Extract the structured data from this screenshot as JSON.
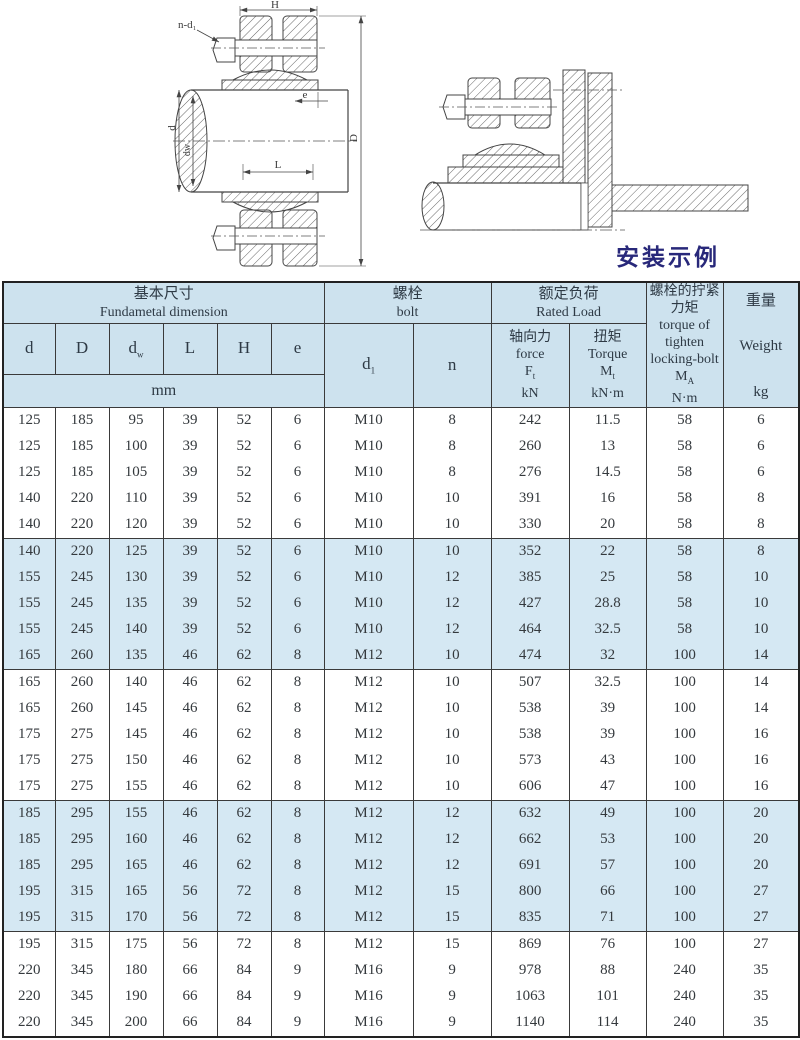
{
  "page": {
    "background": "#ffffff"
  },
  "drawing_left": {
    "labels": {
      "h": "H",
      "nd1": "n-d₁",
      "d": "d",
      "dw": "dw",
      "l": "L",
      "e": "e",
      "big_d": "D"
    }
  },
  "drawing_right": {
    "caption": "安装示例"
  },
  "colors": {
    "header_bg": "#cde2ee",
    "band_bg": "#d5e8f3",
    "caption": "#28287a",
    "border": "#3a3a3a"
  },
  "table": {
    "header": {
      "basic": {
        "zh": "基本尺寸",
        "en": "Fundametal  dimension",
        "unit": "mm"
      },
      "cols": [
        {
          "base": "d",
          "sub": ""
        },
        {
          "base": "D",
          "sub": ""
        },
        {
          "base": "d",
          "sub": "w"
        },
        {
          "base": "L",
          "sub": ""
        },
        {
          "base": "H",
          "sub": ""
        },
        {
          "base": "e",
          "sub": ""
        }
      ],
      "bolt": {
        "zh": "螺栓",
        "en": "bolt",
        "d_base": "d",
        "d_sub": "1",
        "n": "n"
      },
      "load": {
        "zh": "额定负荷",
        "en": "Rated Load"
      },
      "force": {
        "zh": "轴向力",
        "en": "force",
        "sym": "F",
        "sym_sub": "t",
        "unit": "kN"
      },
      "torque": {
        "zh": "扭矩",
        "en": "Torque",
        "sym": "M",
        "sym_sub": "t",
        "unit": "kN·m"
      },
      "tighten": {
        "zh1": "螺栓的拧紧",
        "zh2": "力矩",
        "en1": "torque of",
        "en2": "tighten",
        "en3": "locking-bolt",
        "sym": "M",
        "sym_sub": "A",
        "unit": "N·m"
      },
      "weight": {
        "zh": "重量",
        "en": "Weight",
        "unit": "kg"
      }
    },
    "rows": [
      [
        "125",
        "185",
        "95",
        "39",
        "52",
        "6",
        "M10",
        "8",
        "242",
        "11.5",
        "58",
        "6"
      ],
      [
        "125",
        "185",
        "100",
        "39",
        "52",
        "6",
        "M10",
        "8",
        "260",
        "13",
        "58",
        "6"
      ],
      [
        "125",
        "185",
        "105",
        "39",
        "52",
        "6",
        "M10",
        "8",
        "276",
        "14.5",
        "58",
        "6"
      ],
      [
        "140",
        "220",
        "110",
        "39",
        "52",
        "6",
        "M10",
        "10",
        "391",
        "16",
        "58",
        "8"
      ],
      [
        "140",
        "220",
        "120",
        "39",
        "52",
        "6",
        "M10",
        "10",
        "330",
        "20",
        "58",
        "8"
      ],
      [
        "140",
        "220",
        "125",
        "39",
        "52",
        "6",
        "M10",
        "10",
        "352",
        "22",
        "58",
        "8"
      ],
      [
        "155",
        "245",
        "130",
        "39",
        "52",
        "6",
        "M10",
        "12",
        "385",
        "25",
        "58",
        "10"
      ],
      [
        "155",
        "245",
        "135",
        "39",
        "52",
        "6",
        "M10",
        "12",
        "427",
        "28.8",
        "58",
        "10"
      ],
      [
        "155",
        "245",
        "140",
        "39",
        "52",
        "6",
        "M10",
        "12",
        "464",
        "32.5",
        "58",
        "10"
      ],
      [
        "165",
        "260",
        "135",
        "46",
        "62",
        "8",
        "M12",
        "10",
        "474",
        "32",
        "100",
        "14"
      ],
      [
        "165",
        "260",
        "140",
        "46",
        "62",
        "8",
        "M12",
        "10",
        "507",
        "32.5",
        "100",
        "14"
      ],
      [
        "165",
        "260",
        "145",
        "46",
        "62",
        "8",
        "M12",
        "10",
        "538",
        "39",
        "100",
        "14"
      ],
      [
        "175",
        "275",
        "145",
        "46",
        "62",
        "8",
        "M12",
        "10",
        "538",
        "39",
        "100",
        "16"
      ],
      [
        "175",
        "275",
        "150",
        "46",
        "62",
        "8",
        "M12",
        "10",
        "573",
        "43",
        "100",
        "16"
      ],
      [
        "175",
        "275",
        "155",
        "46",
        "62",
        "8",
        "M12",
        "10",
        "606",
        "47",
        "100",
        "16"
      ],
      [
        "185",
        "295",
        "155",
        "46",
        "62",
        "8",
        "M12",
        "12",
        "632",
        "49",
        "100",
        "20"
      ],
      [
        "185",
        "295",
        "160",
        "46",
        "62",
        "8",
        "M12",
        "12",
        "662",
        "53",
        "100",
        "20"
      ],
      [
        "185",
        "295",
        "165",
        "46",
        "62",
        "8",
        "M12",
        "12",
        "691",
        "57",
        "100",
        "20"
      ],
      [
        "195",
        "315",
        "165",
        "56",
        "72",
        "8",
        "M12",
        "15",
        "800",
        "66",
        "100",
        "27"
      ],
      [
        "195",
        "315",
        "170",
        "56",
        "72",
        "8",
        "M12",
        "15",
        "835",
        "71",
        "100",
        "27"
      ],
      [
        "195",
        "315",
        "175",
        "56",
        "72",
        "8",
        "M12",
        "15",
        "869",
        "76",
        "100",
        "27"
      ],
      [
        "220",
        "345",
        "180",
        "66",
        "84",
        "9",
        "M16",
        "9",
        "978",
        "88",
        "240",
        "35"
      ],
      [
        "220",
        "345",
        "190",
        "66",
        "84",
        "9",
        "M16",
        "9",
        "1063",
        "101",
        "240",
        "35"
      ],
      [
        "220",
        "345",
        "200",
        "66",
        "84",
        "9",
        "M16",
        "9",
        "1140",
        "114",
        "240",
        "35"
      ]
    ],
    "highlight_rows": [
      5,
      6,
      7,
      8,
      9,
      15,
      16,
      17,
      18,
      19
    ],
    "group_starts": [
      5,
      10,
      15,
      20
    ]
  }
}
